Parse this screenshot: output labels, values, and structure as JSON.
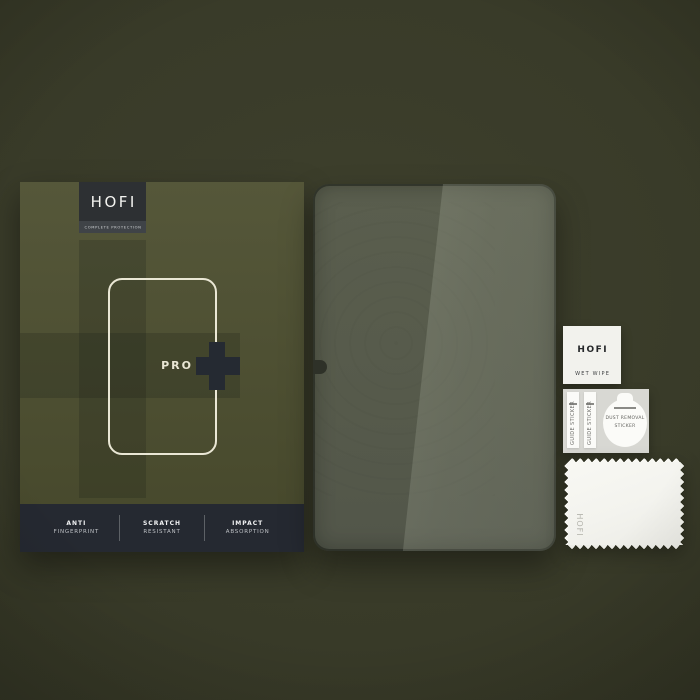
{
  "box": {
    "brand": "HOFI",
    "tagline": "COMPLETE PROTECTION",
    "series": "PRO",
    "features": [
      {
        "line1": "ANTI",
        "line2": "FINGERPRINT"
      },
      {
        "line1": "SCRATCH",
        "line2": "RESISTANT"
      },
      {
        "line1": "IMPACT",
        "line2": "ABSORPTION"
      }
    ]
  },
  "accessories": {
    "wet_wipe": {
      "brand": "HOFI",
      "label": "WET WIPE"
    },
    "sticker_sheet": {
      "guide_label": "GUIDE STICKER",
      "dust_line1": "DUST REMOVAL",
      "dust_line2": "STICKER"
    },
    "cloth": {
      "brand": "HOFI"
    }
  },
  "colors": {
    "background_olive": "#383a28",
    "box_olive": "#4c4e2f",
    "cross_overlay": "#42452a",
    "logo_plate_dark": "#2d3033",
    "feature_bar_dark": "#252931",
    "accent_cream": "#eae7d5",
    "glass_dark": "#565a4b",
    "glass_highlight": "#6f7366",
    "accessory_white": "#f2f2ed",
    "sticker_sheet_gray": "#d8d8d3"
  }
}
